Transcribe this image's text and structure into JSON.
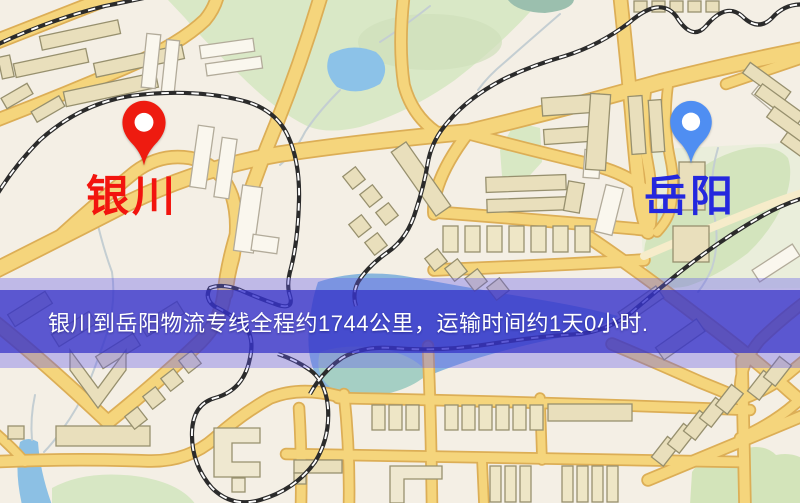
{
  "map": {
    "origin": {
      "label": "银川",
      "label_color": "#f2140e",
      "pin_color": "#ee1b10"
    },
    "destination": {
      "label": "岳阳",
      "label_color": "#2428de",
      "pin_color": "#4f8ef2"
    }
  },
  "banner": {
    "text": "银川到岳阳物流专线全程约1744公里，运输时间约1天0小时.",
    "bg_color": "rgba(48,46,198,0.70)",
    "halo_color": "rgba(96,90,235,0.36)",
    "text_color": "#ffffff"
  },
  "palette": {
    "background": "#f4efe5",
    "road": "#f5d57c",
    "road_border": "#dcae56",
    "road_minor": "#f6ecca",
    "park": "#d7e7c5",
    "park_dark": "#cfe0ba",
    "water": "#8cc0e4",
    "water_teal": "#a5cfc4",
    "building": "#e9dfbc",
    "building_light": "#faf7ee",
    "railway": "#2b2b2b"
  }
}
